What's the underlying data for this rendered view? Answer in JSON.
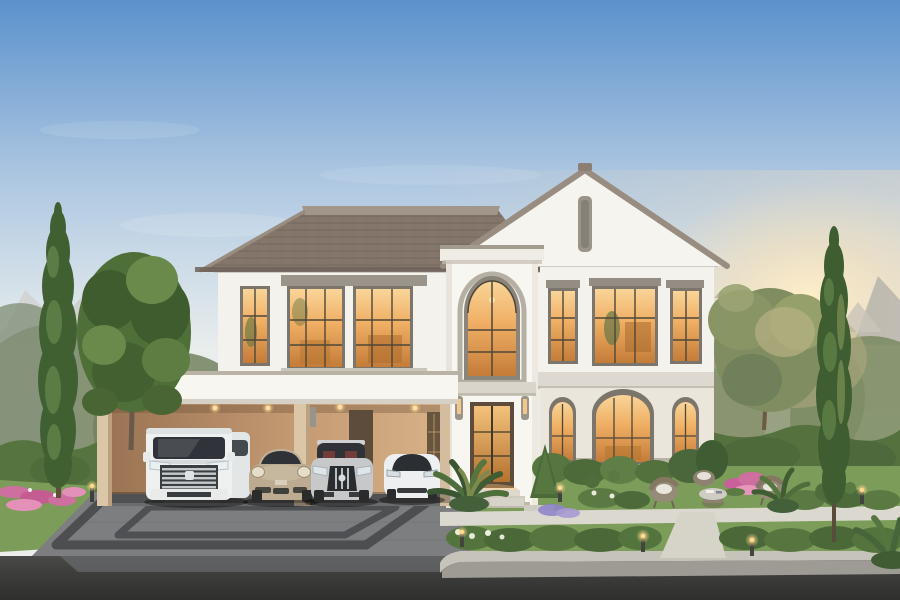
{
  "meta": {
    "kind": "architectural-rendering",
    "description": "Dusk exterior rendering of a white two-story modern-classic house with tiled hip-and-gable roof, arched entry tower, four-bay carport with four cars, landscaped front garden, paved driveway and asphalt road."
  },
  "scene": {
    "setting": "dusk, warm interior lights glowing, low sun at right",
    "house": "white two-story house with gable, arched entry tower, carport",
    "vehicles": [
      "white minivan",
      "champagne sports car",
      "silver luxury sedan",
      "white electric crossover"
    ],
    "landscape": [
      "tall cypress trees",
      "round canopy tree",
      "clipped hedges",
      "pink flower beds",
      "stone walkways",
      "wicker patio set with round table",
      "glowing bollard lights"
    ],
    "foreground": "paved driveway with dark accent banding meeting an asphalt road with concrete curb"
  },
  "palette": {
    "sky_top": "#5b92cc",
    "sky_mid": "#a9c4e0",
    "sky_horizon": "#e9edec",
    "sun_glow": "#ffeec8",
    "warm_wash": "#f5debc",
    "roof_tile": "#84766a",
    "roof_ridge": "#a2968a",
    "coping_gray": "#988d80",
    "wall_white": "#f4f2ec",
    "wall_first_floor": "#eae6db",
    "trim_gray": "#ddd9d0",
    "window_frame": "#7b756b",
    "glow_top": "#f9d598",
    "glow_mid": "#efae63",
    "glow_deep": "#c47c39",
    "carport_wall": "#c49a72",
    "column_beige": "#dcc6a8",
    "door_brown": "#5d4b3c",
    "fascia_white": "#f7f6f1",
    "grass": "#7c9c5a",
    "hedge": "#55743f",
    "tree_dark": "#416032",
    "tree_light": "#5c7c46",
    "canopy_green": "#4e7038",
    "background_tree": "#7b8a68",
    "flower_pink": "#cf6f9f",
    "path_light": "#dbd8cf",
    "driveway": "#7d7e80",
    "driveway_accent": "#4d4e50",
    "road": "#3d3d3b",
    "curb": "#c6c3bb",
    "car_white": "#eff1f1",
    "car_champagne": "#bcab90",
    "car_silver": "#c6c8c9",
    "glass_dark": "#30343a",
    "wicker": "#968b78",
    "bollard_glow": "#ffd98e"
  }
}
